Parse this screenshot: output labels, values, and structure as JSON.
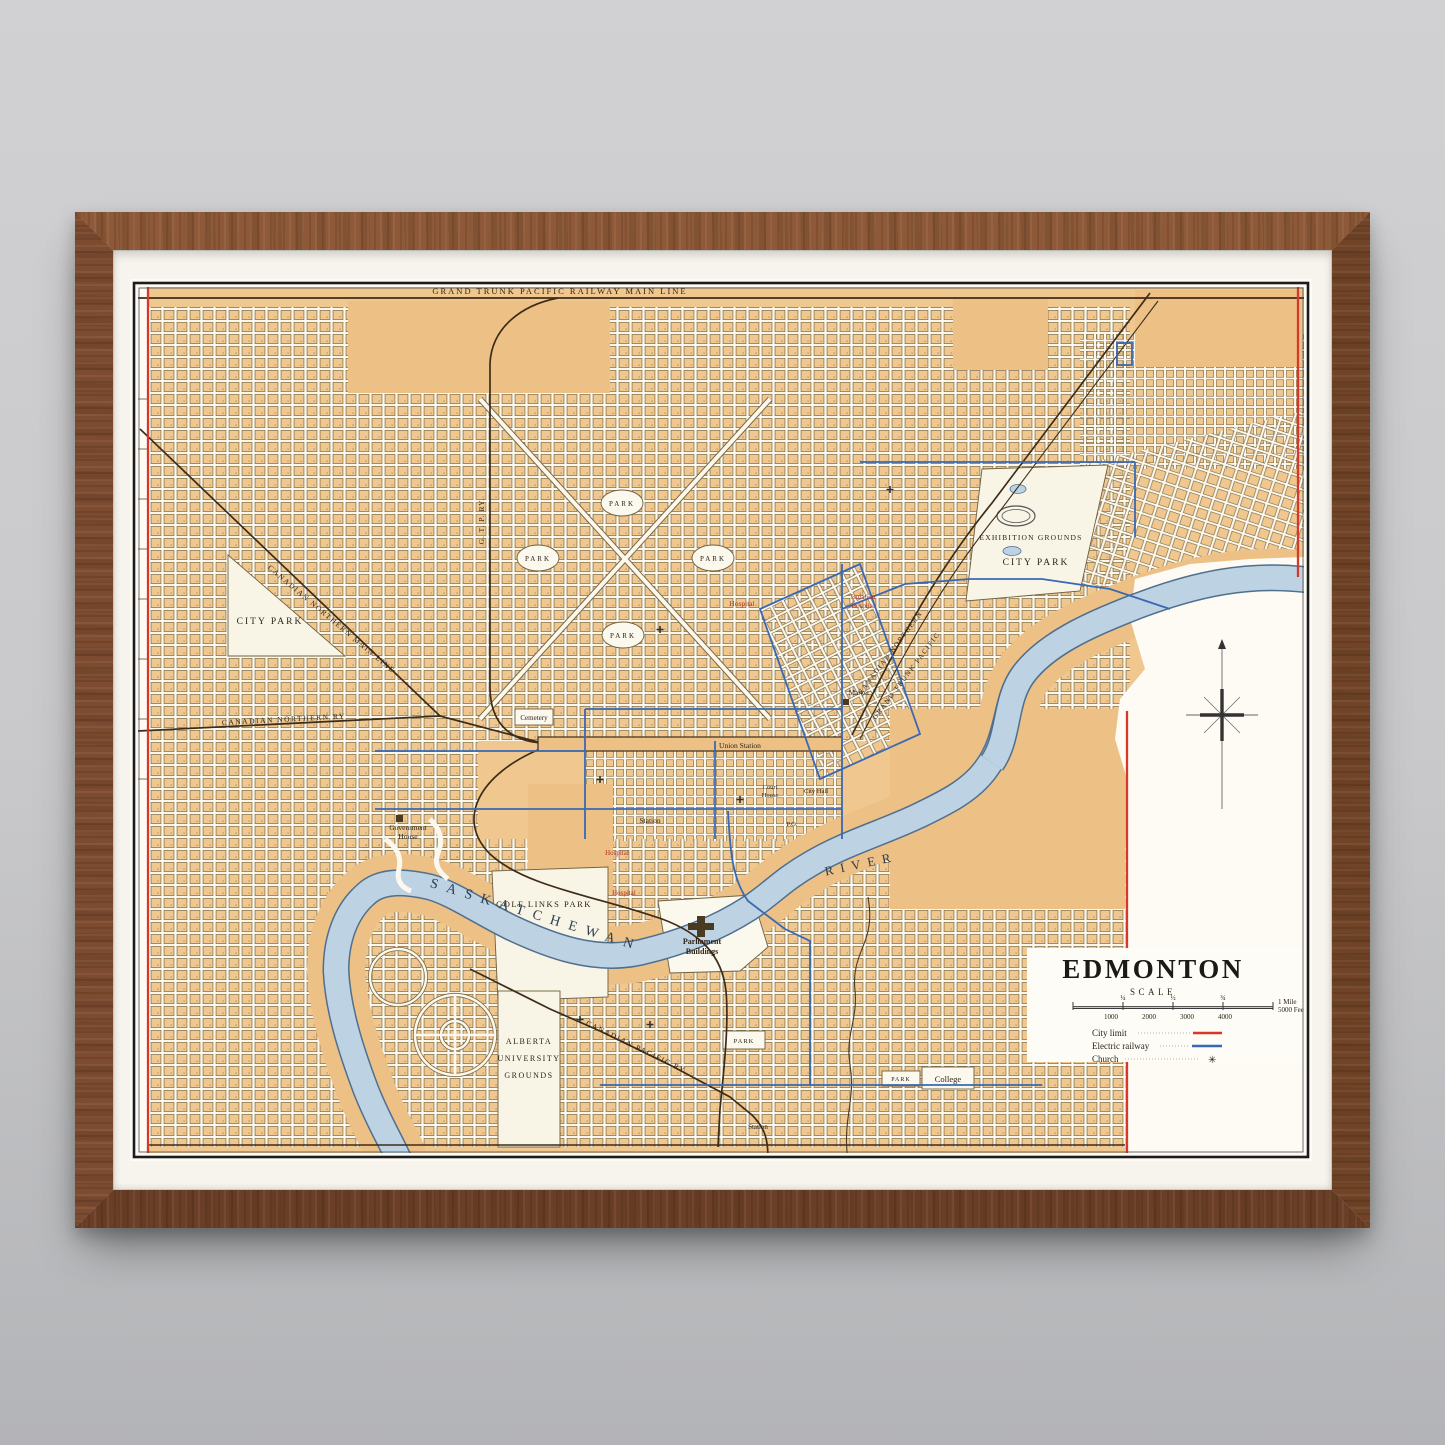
{
  "scene": {
    "description": "Framed antique city map hanging on a gray wall",
    "frame_material": "walnut wood",
    "mat_color": "#f6f4ec"
  },
  "palette": {
    "wall_top": "#d1d1d3",
    "wall_bottom": "#b3b4b7",
    "wood": "#7d4b30",
    "tan": "#f0c78e",
    "street": "#fcf8ee",
    "river": "#bdd2e2",
    "river_edge": "#4f6f8f",
    "rail": "#3e2c18",
    "electric": "#3a68b2",
    "city_limit": "#d6392b",
    "ink": "#2e2418",
    "red_ink": "#b33325",
    "water_ink": "#2c3e50"
  },
  "map": {
    "labels": {
      "gtp_main": "GRAND TRUNK PACIFIC RAILWAY MAIN LINE",
      "cn_main": "CANADIAN NORTHERN MAIN LINE",
      "cn_ry": "CANADIAN NORTHERN RY",
      "gtp_ry": "G. T. P. RY.",
      "cn_diag": "CANADIAN NORTHERN",
      "gtp_diag": "GRAND TRUNK PACIFIC",
      "cp_ry": "CANADIAN PACIFIC RY",
      "city_park_west": "CITY PARK",
      "city_park_ne": "CITY PARK",
      "exhibition_grounds": "EXHIBITION GROUNDS",
      "park": "PARK",
      "cemetery": "Cemetery",
      "market": "Market",
      "union_station": "Union Station",
      "station_downtown": "Station",
      "station_south": "Station",
      "court_house": [
        "Court",
        "House"
      ],
      "city_hall": "City Hall",
      "post_office": "P.O.",
      "government_house": [
        "Government",
        "House"
      ],
      "hospital": "Hospital",
      "isolation_hospital": [
        "Isolation",
        "Hospital"
      ],
      "golf_links_park": "GOLF LINKS PARK",
      "parliament_buildings": [
        "Parliament",
        "Buildings"
      ],
      "university": [
        "ALBERTA",
        "UNIVERSITY",
        "GROUNDS"
      ],
      "college": "College",
      "river": [
        "SASKATCHEWAN",
        "RIVER"
      ]
    },
    "cartouche": {
      "title": "EDMONTON",
      "scale_heading": "SCALE",
      "mile_fractions": [
        "¼",
        "½",
        "¾"
      ],
      "mile_unit": "1 Mile",
      "feet_ticks": [
        "1000",
        "2000",
        "3000",
        "4000"
      ],
      "feet_unit": "5000 Feet",
      "legend": [
        {
          "label": "City limit",
          "style": "red-line"
        },
        {
          "label": "Electric railway",
          "style": "blue-line"
        },
        {
          "label": "Church",
          "symbol": "✳"
        }
      ]
    }
  }
}
